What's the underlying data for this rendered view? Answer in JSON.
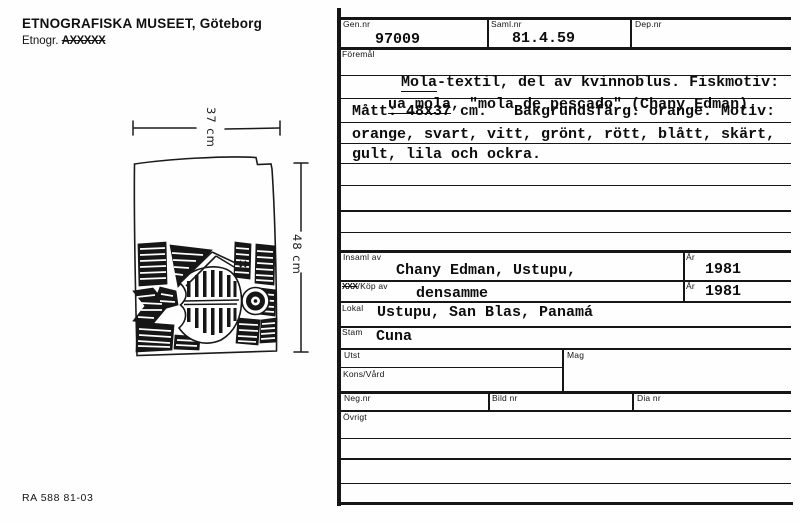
{
  "header": {
    "museum": "ETNOGRAFISKA MUSEET, Göteborg",
    "etnogr_prefix": "Etnogr.",
    "etnogr_struck": "AXXXXX"
  },
  "footer": {
    "form_code": "RA 588  81-03"
  },
  "sketch": {
    "width_label": "37 cm",
    "height_label": "48 cm"
  },
  "labels": {
    "gen_nr": "Gen.nr",
    "saml_nr": "Saml.nr",
    "dep_nr": "Dep.nr",
    "foremal": "Föremål",
    "insaml_av": "Insaml av",
    "ar": "År",
    "kop_struck": "XXX",
    "kop_av": "/Köp av",
    "lokal": "Lokal",
    "stam": "Stam",
    "utst": "Utst",
    "mag": "Mag",
    "kons_vard": "Kons/Vård",
    "neg_nr": "Neg.nr",
    "bild_nr": "Bild nr",
    "dia_nr": "Dia nr",
    "ovrigt": "Övrigt"
  },
  "values": {
    "gen_nr": "97009",
    "saml_nr": "81.4.59",
    "insaml_av": "Chany Edman, Ustupu,",
    "insaml_ar": "1981",
    "kop_av": "densamme",
    "kop_ar": "1981",
    "lokal": "Ustupu, San Blas, Panamá",
    "stam": "Cuna"
  },
  "foremal": {
    "l1_u": "Mola",
    "l1_rest": "-textil, del av kvinnoblus. Fiskmotiv:",
    "l2_u": "ua mola",
    "l2_rest": ", \"mola de pescado\" (Chany Edman).",
    "l3": "Mått: 48x37 cm.   Bakgrundsfärg: orange. Motiv:",
    "l4": "orange, svart, vitt, grönt, rött, blått, skärt,",
    "l5": "gult, lila och ockra."
  }
}
